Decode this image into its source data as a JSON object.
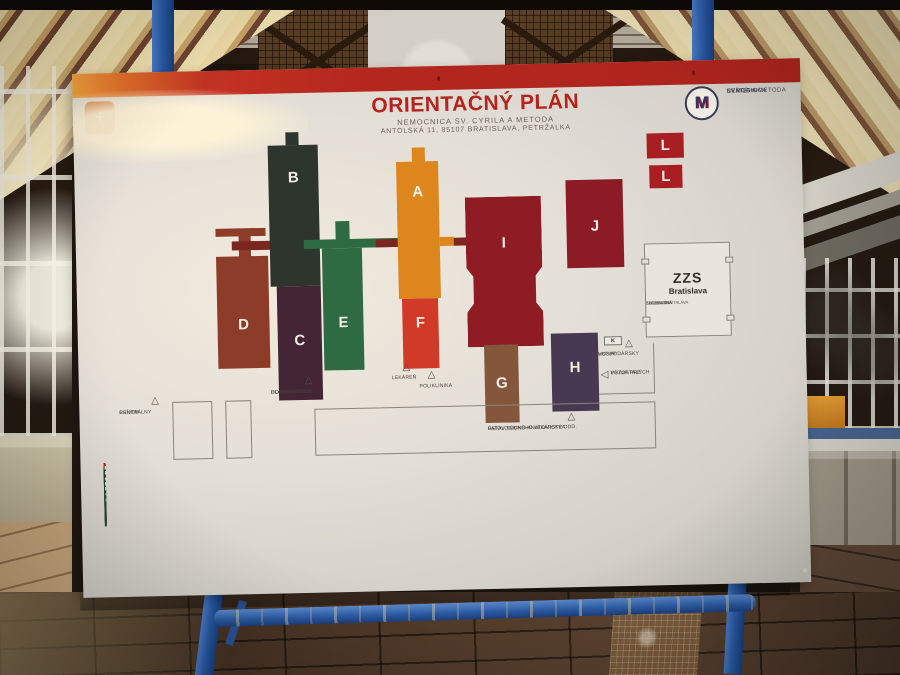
{
  "colors": {
    "accent_red": "#b5231c",
    "frame_blue": "#2e5fa8",
    "board_white": "#e4dfd7"
  },
  "sign": {
    "header": {
      "title": "ORIENTAČNÝ PLÁN",
      "subtitle1": "NEMOCNICA SV. CYRILA A METODA",
      "subtitle2": "ANTOLSKÁ 11, 85107 BRATISLAVA, PETRŽALKA",
      "left_logo_text": "NEMOCNICA",
      "right_logo_line1": "NEMOCNICA",
      "right_logo_line2": "SVÄTÉHO",
      "right_logo_line3": "CYRILA A METODA",
      "left_logo_cross": "+",
      "right_logo_monogram": "M"
    },
    "map": {
      "buildings": [
        {
          "id": "A",
          "letter": "A",
          "color": "#dd861c"
        },
        {
          "id": "B",
          "letter": "B",
          "color": "#2d352c"
        },
        {
          "id": "C",
          "letter": "C",
          "color": "#432536"
        },
        {
          "id": "D",
          "letter": "D",
          "color": "#8e3c2a"
        },
        {
          "id": "E",
          "letter": "E",
          "color": "#2f6b42"
        },
        {
          "id": "F",
          "letter": "F",
          "color": "#d23a28"
        },
        {
          "id": "G",
          "letter": "G",
          "color": "#84573d"
        },
        {
          "id": "H",
          "letter": "H",
          "color": "#473952"
        },
        {
          "id": "I",
          "letter": "I",
          "color": "#8f1c24"
        },
        {
          "id": "J",
          "letter": "J",
          "color": "#8c1b26"
        },
        {
          "id": "L",
          "letter": "L",
          "color": "#a81e22"
        }
      ],
      "zzs1": "ZZS",
      "zzs2": "Bratislava",
      "zzs3": "ZÁCHRANNÁ",
      "zzs4": "ZDRAVOTNÁ",
      "zzs5": "SLUŽBA BRATISLAVA",
      "k_label": "K",
      "entrances": {
        "central1": "CENTRÁLNY",
        "central2": "PRÍJEM",
        "main1": "HLAVNÝ VSTUP",
        "main2": "DO NEMOCNICE",
        "lekaren": "LEKÁREŇ",
        "poliklinika": "POLIKLINIKA",
        "hosp1": "HOSPODÁRSKY",
        "hosp2": "VSTUP",
        "poz1": "VSTUP PRE",
        "poz2": "POZOSTALÝCH",
        "pat1": "PATOLOGICKO-ANATOMICKÉ ODD.",
        "pat2": "ÚSTAV SÚDNEHO LEKÁRSTVA"
      }
    },
    "legend": {
      "colors": {
        "orange": "#bf6218",
        "maroon": "#3e2029",
        "darkmaroon": "#321420",
        "reddark": "#67202a",
        "green": "#1d4934",
        "red": "#bd1f16",
        "tan": "#9a6a4a",
        "purple": "#403254"
      },
      "footnote": "D",
      "columns": [
        {
          "panels": [
            {
              "bg": "orange",
              "grow": true,
              "header": "Blok A",
              "sub": "poschodie",
              "rows": [
                {
                  "f": "-1",
                  "t": "Technické priestory nemocnice"
                },
                {
                  "f": "0",
                  "t": "Psychiatrické oddelenie"
                },
                {
                  "f": "",
                  "t": "Prechod k ambulanciám do bloku F - Poliklinika, Ambulancie"
                },
                {
                  "f": "1",
                  "t": "Klinika hematológie a transfuziológie LFUK, SZU a UNB - lôžková časť, Materská škola"
                },
                {
                  "f": "",
                  "t": "Prechod k ambulanciám do bloku F - Poliklinika, Ambulancie"
                },
                {
                  "f": "2",
                  "t": "Klinika pre deti a dorast A.Getlíka SZU a UNB, Základná škola nemocnice"
                },
                {
                  "f": "",
                  "t": "Katedra pediatrie SZU"
                },
                {
                  "f": "",
                  "t": "Pediatrické oddelenie"
                },
                {
                  "f": "3",
                  "t": "I. gyn.- pôrod. klinika LFUK a UNB"
                },
                {
                  "f": "",
                  "t": "Pôrodnica"
                },
                {
                  "f": "4",
                  "t": "I. gyn.- pôrod. klinika LFUK a UNB - šestonedelie"
                }
              ]
            }
          ]
        },
        {
          "panels": [
            {
              "bg": "orange",
              "h": 60,
              "rows": [
                {
                  "f": "4",
                  "t": "Novorodenecká klinika M. Rusnáka SZU - JVSM, Rooming in"
                },
                {
                  "f": "5",
                  "t": "I. gyn.- pôrod. klinika LFUK a UNB - riziková a patologická gravidita"
                },
                {
                  "f": "",
                  "t": "I. gyn.- pôrod. klinika LFUK a UNB - Operačné oddelenie"
                },
                {
                  "f": "6",
                  "t": "Novorodenecká klinika M. Rusnáka SZU - JISN"
                },
                {
                  "f": "",
                  "t": "Oddelenie dlhodobo chorých"
                }
              ]
            },
            {
              "bg": "maroon",
              "grow": true,
              "header": "Blok B",
              "sub": "poschodie",
              "rows": [
                {
                  "f": "-1",
                  "t": "Oddelenie centrálnej sterilizácie"
                },
                {
                  "f": "0",
                  "t": "Oddelenie anesteziológie a intenzívnej medicíny"
                },
                {
                  "f": "1",
                  "t": "II. ortopedicko-traumatologická klinika LFUK a UNB"
                },
                {
                  "f": "2",
                  "t": "II. chirurgická klinika LFUK a UNB"
                },
                {
                  "f": "3",
                  "t": "IV. interná klinika LFUK a UNB"
                }
              ]
            }
          ]
        },
        {
          "panels": [
            {
              "bg": "maroon",
              "h": 58,
              "rows": [
                {
                  "f": "4",
                  "t": "Oddelenie cievnej chirurgie"
                },
                {
                  "f": "",
                  "t": "Neurologické oddelenie"
                },
                {
                  "f": "5",
                  "t": "Klinika otorinolaryngológie a chirurgie hlavy a krku LFUK a UNB, Audiológia, Vestibulológia"
                },
                {
                  "f": "6",
                  "t": "Urologické oddelenie"
                },
                {
                  "f": "",
                  "t": "Gastroenterologická klinika SZU a UNB"
                },
                {
                  "f": "7",
                  "t": "Očná klinika SZU a UNB"
                },
                {
                  "f": "",
                  "t": "Fyziatricko-rehabilitačné oddelenie - lôžková časť"
                }
              ]
            },
            {
              "bg": "darkmaroon",
              "grow": true,
              "header": "Blok C",
              "sub": "poschodie",
              "rows": [
                {
                  "f": "-1",
                  "t": "Centrálne prijímacie oddelenie, OĽZ prijímacia kancelária, šatne, pokladňa"
                },
                {
                  "f": "0",
                  "t": "Hlavný vstup"
                },
                {
                  "f": "1",
                  "t": "Riaditeľstvo, podateľňa"
                },
                {
                  "f": "2",
                  "t": "Odd. personálnej práce a miezd, Ekonom. odd., MTZ."
                }
              ]
            }
          ]
        },
        {
          "panels": [
            {
              "bg": "darkmaroon",
              "h": 25,
              "rows": [
                {
                  "f": "3",
                  "t": "Kongresová sála, malá zasadačka, knižnica"
                }
              ]
            },
            {
              "bg": "reddark",
              "grow": true,
              "header": "Blok D",
              "sub": "poschodie",
              "rows": [
                {
                  "f": "-1",
                  "t": "Magnetická rezonancia a CT"
                },
                {
                  "f": "0",
                  "t": "Fyziatricko-rehabilitačné oddelenie - liečebná rehabilitácia, ambulancie"
                },
                {
                  "f": "",
                  "t": "Bufet"
                },
                {
                  "f": "1",
                  "t": "Rádiologická klinika LFUK, SZU a UNB"
                },
                {
                  "f": "",
                  "t": "Gastroenterologická klinika SZU a UNB - Endoskopia"
                },
                {
                  "f": "2",
                  "t": "Centrálne klinické laboratóriá"
                },
                {
                  "f": "",
                  "t": "Odd. klinickej biochémie"
                },
                {
                  "f": "",
                  "t": "Odd. klinickej imunológie"
                },
                {
                  "f": "",
                  "t": "Odd. klinickej mikrobiológie"
                },
                {
                  "f": "",
                  "t": "Klinika hematológie a transfuziológie LFUK, SZU a UNB - špeciálne laboratóriá"
                }
              ]
            }
          ]
        },
        {
          "panels": [
            {
              "bg": "green",
              "h": 63,
              "header": "Blok E",
              "sub": "Poschodie",
              "rows": [
                {
                  "f": "-1",
                  "t": "Odd. centrálnej sterilizácie"
                },
                {
                  "f": "0",
                  "t": "FMC - Dialýza"
                },
                {
                  "f": "1",
                  "t": "Odd. ústredných operačných sál - sály IX. - XI."
                },
                {
                  "f": "1",
                  "t": "Klinika hematológie a transfuziológie LFUK, SZU a UNB - ambulantná časť"
                },
                {
                  "f": "",
                  "t": "Národné hemofilické centrum, Krvná banka"
                },
                {
                  "f": "2",
                  "t": "Odd. ústredných operačných sál - sály I. - VIII."
                }
              ]
            },
            {
              "bg": "red",
              "grow": true,
              "header": "Blok F",
              "sub": "Poschodie",
              "title": "POLIKLINIKA",
              "rows": [
                {
                  "f": "-1",
                  "t": "Ambulancie"
                },
                {
                  "f": "",
                  "t": "Odd. neinvazívnej kardiológie"
                },
                {
                  "f": "0",
                  "t": "Ambulancie"
                },
                {
                  "f": "0",
                  "t": "Verejná lekáreň UNB"
                }
              ]
            }
          ]
        },
        {
          "panels": [
            {
              "bg": "red",
              "grow": true,
              "rows": [
                {
                  "f": "1",
                  "t": "Ambulancie"
                },
                {
                  "f": "Blok G",
                  "t": "Nemocničná lekáreň",
                  "bg": "tan"
                },
                {
                  "f": "Blok H",
                  "t": "Oddelenie patologickej anatómie, Ústav súdneho lekárstva",
                  "bg": "purple"
                },
                {
                  "f": "Blok I",
                  "t": "Dodávková centrála"
                },
                {
                  "f": "Blok J",
                  "t": "Energoblok"
                },
                {
                  "f": "Blok K",
                  "t": "Hospodárska vrátnica"
                },
                {
                  "f": "Blok L",
                  "t": "Sklady"
                }
              ]
            }
          ]
        }
      ]
    }
  }
}
